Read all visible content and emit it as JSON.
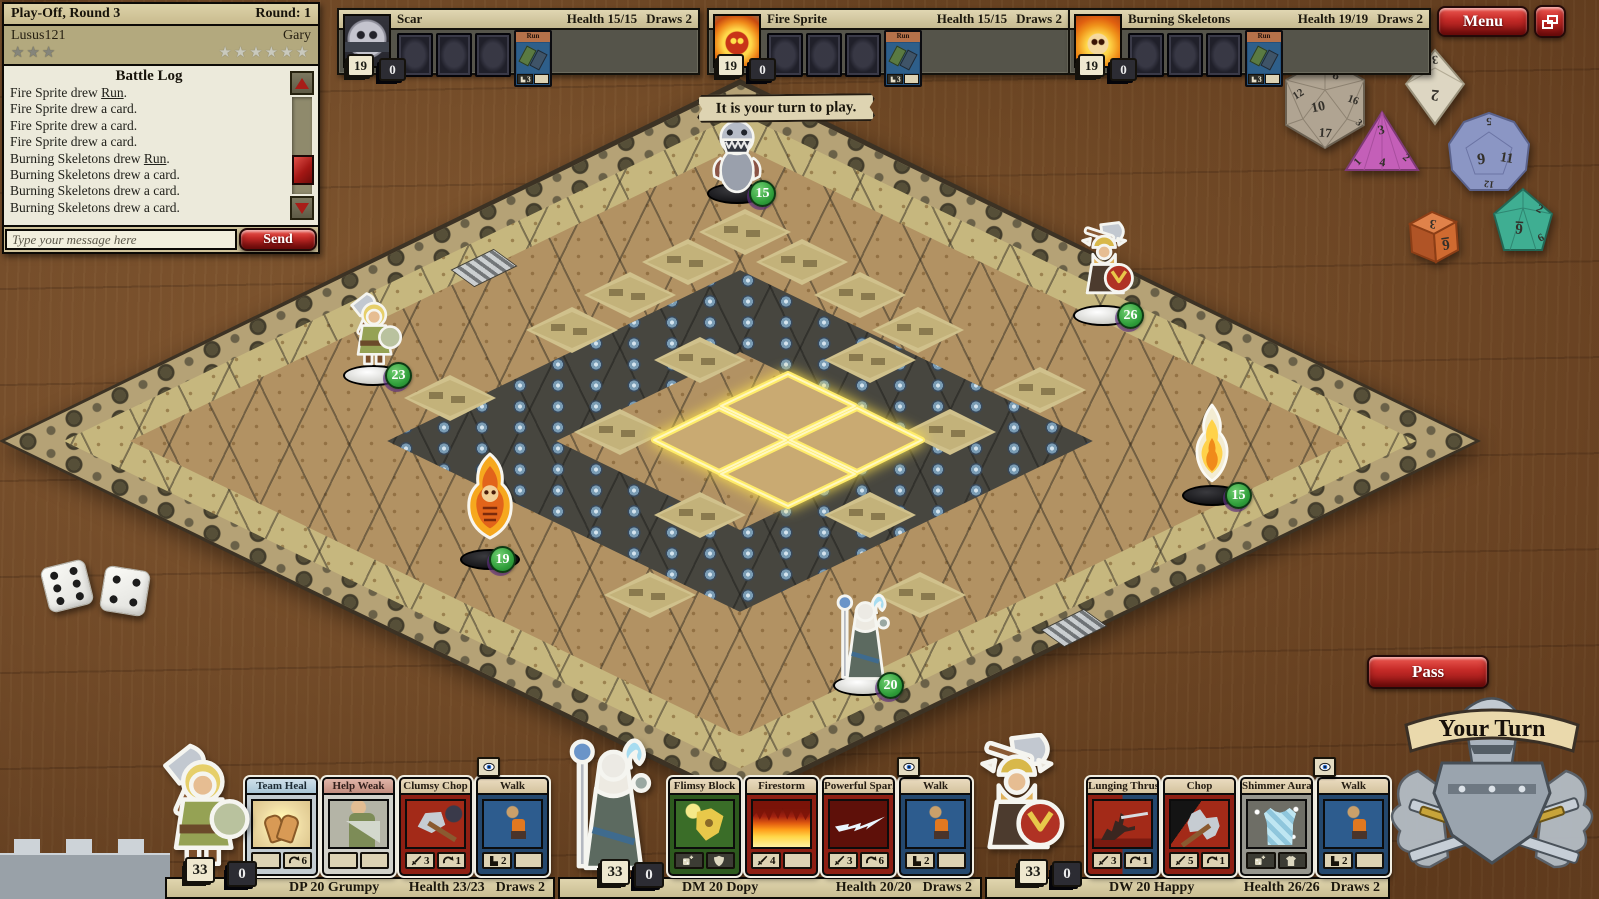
{
  "banner": {
    "turn_message": "It is your turn to play."
  },
  "buttons": {
    "menu": "Menu",
    "pass": "Pass",
    "send": "Send",
    "your_turn": "Your Turn"
  },
  "match": {
    "title": "Play-Off, Round 3",
    "round": "Round: 1",
    "left_player": "Lusus121",
    "right_player": "Gary",
    "left_stars": "★★★",
    "right_stars": "★★★★★★",
    "log_title": "Battle Log",
    "chat_placeholder": "Type your message here",
    "log": [
      {
        "pre": "Fire Sprite drew ",
        "em": "Run",
        "post": "."
      },
      {
        "pre": "Fire Sprite drew a card.",
        "em": "",
        "post": ""
      },
      {
        "pre": "Fire Sprite drew a card.",
        "em": "",
        "post": ""
      },
      {
        "pre": "Fire Sprite drew a card.",
        "em": "",
        "post": ""
      },
      {
        "pre": "Burning Skeletons drew ",
        "em": "Run",
        "post": "."
      },
      {
        "pre": "Burning Skeletons drew a card.",
        "em": "",
        "post": ""
      },
      {
        "pre": "Burning Skeletons drew a card.",
        "em": "",
        "post": ""
      },
      {
        "pre": "Burning Skeletons drew a card.",
        "em": "",
        "post": ""
      }
    ]
  },
  "enemies": [
    {
      "name": "Scar",
      "health": "Health 15/15",
      "draws": "Draws 2",
      "deck": "19",
      "discard": "0",
      "card_title": "Run",
      "card_move": "3",
      "facedown_cards": 3
    },
    {
      "name": "Fire Sprite",
      "health": "Health 15/15",
      "draws": "Draws 2",
      "deck": "19",
      "discard": "0",
      "card_title": "Run",
      "card_move": "3",
      "facedown_cards": 3
    },
    {
      "name": "Burning Skeletons",
      "health": "Health 19/19",
      "draws": "Draws 2",
      "deck": "19",
      "discard": "0",
      "card_title": "Run",
      "card_move": "3",
      "facedown_cards": 3
    }
  ],
  "tokens": [
    {
      "name": "Scar",
      "hp": "15",
      "base": "black"
    },
    {
      "name": "Grumpy",
      "hp": "23",
      "base": "white"
    },
    {
      "name": "Happy",
      "hp": "26",
      "base": "white"
    },
    {
      "name": "Burning Skeleton",
      "hp": "19",
      "base": "black"
    },
    {
      "name": "Fire Sprite",
      "hp": "15",
      "base": "black"
    },
    {
      "name": "Dopy",
      "hp": "20",
      "base": "white"
    }
  ],
  "players": [
    {
      "name": "DP 20 Grumpy",
      "health": "Health 23/23",
      "draws": "Draws 2",
      "deck": "33",
      "discard": "0",
      "cards": [
        {
          "title": "Team Heal",
          "s1_icon": "",
          "s1": "",
          "s2_icon": "curved-arrow",
          "s2": "6"
        },
        {
          "title": "Help Weak",
          "s1_icon": "",
          "s1": "",
          "s2_icon": "",
          "s2": ""
        },
        {
          "title": "Clumsy Chop",
          "s1_icon": "sword",
          "s1": "3",
          "s2_icon": "curved-arrow",
          "s2": "1"
        },
        {
          "title": "Walk",
          "s1_icon": "boot",
          "s1": "2",
          "s2_icon": "",
          "s2": ""
        }
      ]
    },
    {
      "name": "DM 20 Dopy",
      "health": "Health 20/20",
      "draws": "Draws 2",
      "deck": "33",
      "discard": "0",
      "cards": [
        {
          "title": "Flimsy Block",
          "s1_icon": "die-plus",
          "s1": "",
          "s2_icon": "shield",
          "s2": ""
        },
        {
          "title": "Firestorm",
          "s1_icon": "sword",
          "s1": "4",
          "s2_icon": "",
          "s2": ""
        },
        {
          "title": "Powerful Spark",
          "s1_icon": "sword",
          "s1": "3",
          "s2_icon": "curved-arrow",
          "s2": "6"
        },
        {
          "title": "Walk",
          "s1_icon": "boot",
          "s1": "2",
          "s2_icon": "",
          "s2": ""
        }
      ]
    },
    {
      "name": "DW 20 Happy",
      "health": "Health 26/26",
      "draws": "Draws 2",
      "deck": "33",
      "discard": "0",
      "cards": [
        {
          "title": "Lunging Thrust",
          "s1_icon": "sword",
          "s1": "3",
          "s2_icon": "curved-arrow",
          "s2": "1"
        },
        {
          "title": "Chop",
          "s1_icon": "sword",
          "s1": "5",
          "s2_icon": "curved-arrow",
          "s2": "1"
        },
        {
          "title": "Shimmer Aura",
          "s1_icon": "die-plus",
          "s1": "",
          "s2_icon": "armor",
          "s2": ""
        },
        {
          "title": "Walk",
          "s1_icon": "boot",
          "s1": "2",
          "s2_icon": "",
          "s2": ""
        }
      ]
    }
  ],
  "icons": {
    "slot_icons": [
      "sword-icon",
      "curved-arrow-icon",
      "boot-icon",
      "die-plus-icon",
      "shield-icon",
      "armor-icon"
    ],
    "peek_icon": "eye-icon"
  },
  "colors": {
    "accent_red": "#b01c1c",
    "badge_green": "#2f9e3a",
    "highlight_yellow": "#ffe44d",
    "parchment": "#eceadb",
    "board_khaki": "#c6b77e",
    "board_brown": "#b29263"
  },
  "dice": {
    "d20": {
      "color": "#b0a492",
      "n0": "8",
      "n1": "10",
      "n2": "17",
      "n3": "12",
      "n4": "16",
      "n5": "3"
    },
    "d8": {
      "color": "#ddd6c2",
      "n0": "2",
      "n1": "3"
    },
    "d4": {
      "color": "#c45fb8",
      "n0": "3",
      "n1": "1",
      "n2": "4",
      "n3": "2"
    },
    "d12": {
      "color": "#8b96c4",
      "n0": "5",
      "n1": "9",
      "n2": "11",
      "n3": "12"
    },
    "d6": {
      "color": "#cf6a30",
      "n0": "3",
      "n1": "6"
    },
    "d10": {
      "color": "#3fae92",
      "n0": "2",
      "n1": "6",
      "n2": "9"
    },
    "white_pair": {
      "left_pips": "6",
      "right_pips": "4"
    }
  }
}
